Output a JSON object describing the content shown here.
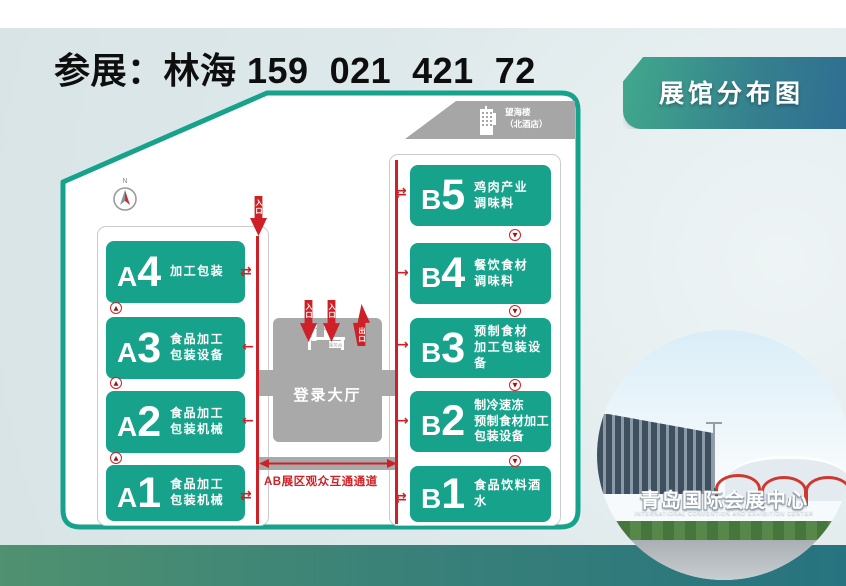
{
  "page": {
    "top_title": "参展：林海 159  021  421  72"
  },
  "badge": {
    "label": "展馆分布图"
  },
  "icons": {
    "arrow_left": "←",
    "arrow_right": "→",
    "arrow_swap": "⇄",
    "arrow_up_small": "▲",
    "arrow_down_small": "▼"
  },
  "map": {
    "compass_label": "N",
    "hotel_label_line1": "望海楼",
    "hotel_label_line2": "（北酒店）",
    "entrance_label": "入口",
    "exit_label": "出口",
    "service_desk_label": "服务台",
    "lobby_label": "登录大厅",
    "corridor_label": "AB展区观众互通通道",
    "halls_a": [
      {
        "id_letter": "A",
        "id_num": "4",
        "desc_lines": [
          "加工包装"
        ]
      },
      {
        "id_letter": "A",
        "id_num": "3",
        "desc_lines": [
          "食品加工",
          "包装设备"
        ]
      },
      {
        "id_letter": "A",
        "id_num": "2",
        "desc_lines": [
          "食品加工",
          "包装机械"
        ]
      },
      {
        "id_letter": "A",
        "id_num": "1",
        "desc_lines": [
          "食品加工",
          "包装机械"
        ]
      }
    ],
    "halls_b": [
      {
        "id_letter": "B",
        "id_num": "5",
        "desc_lines": [
          "鸡肉产业",
          "调味料"
        ]
      },
      {
        "id_letter": "B",
        "id_num": "4",
        "desc_lines": [
          "餐饮食材",
          "调味料"
        ]
      },
      {
        "id_letter": "B",
        "id_num": "3",
        "desc_lines": [
          "预制食材",
          "加工包装设备"
        ]
      },
      {
        "id_letter": "B",
        "id_num": "2",
        "desc_lines": [
          "制冷速冻",
          "预制食材加工",
          "包装设备"
        ]
      },
      {
        "id_letter": "B",
        "id_num": "1",
        "desc_lines": [
          "食品饮料酒水"
        ]
      }
    ]
  },
  "photo": {
    "sign_text": "青岛国际会展中心",
    "sign_subtext": "INTERNATIONAL CONVENTION AND EXHIBITION CENTER"
  },
  "colors": {
    "hall_green": "#16a28b",
    "flow_red": "#ce2127",
    "lobby_gray": "#a9a9a9",
    "badge_gradient_start": "#41a98c",
    "badge_gradient_end": "#2f6e92",
    "band_gradient_start": "#4f9170",
    "band_gradient_end": "#27737f"
  }
}
